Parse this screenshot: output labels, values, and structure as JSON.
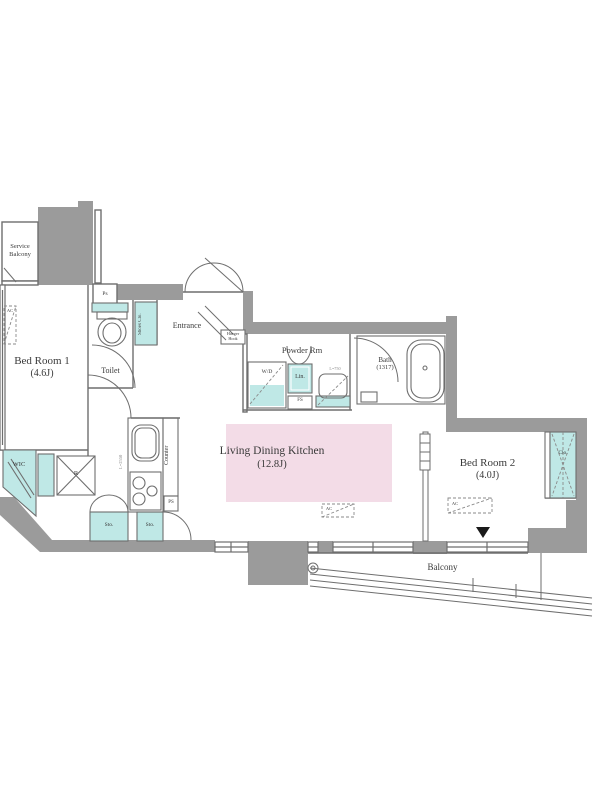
{
  "colors": {
    "wall": "#9b9b9b",
    "teal": "#bfe8e6",
    "pink": "#f3dce7",
    "line": "#6e6e6e",
    "text": "#3a3a3a"
  },
  "rooms": {
    "service_balcony": {
      "line1": "Service",
      "line2": "Balcony"
    },
    "bed_room_1": {
      "name": "Bed Room 1",
      "size": "(4.6J)"
    },
    "toilet": {
      "name": "Toilet"
    },
    "entrance": {
      "name": "Entrance"
    },
    "powder_room": {
      "name": "Powder Rm"
    },
    "bath": {
      "name": "Bath",
      "size": "(1317)"
    },
    "ldk": {
      "name": "Living Dining Kitchen",
      "size": "(12.8J)"
    },
    "bed_room_2": {
      "name": "Bed Room 2",
      "size": "(4.0J)"
    },
    "wic": {
      "name": "WIC"
    },
    "balcony": {
      "name": "Balcony"
    }
  },
  "fixtures": {
    "shoes_closet": "Shoes Clo.",
    "washer_dryer": "W/D",
    "linen": "Lin.",
    "fs": "FS",
    "ps_upper": "Ps",
    "ps_kitchen": "PS",
    "refrigerator": "R",
    "counter": "Counter",
    "storage_left": "Sto.",
    "storage_right": "Sto.",
    "closet_bedroom2": "Clo.",
    "hanger_hook": {
      "line1": "Hanger",
      "line2": "Hook"
    },
    "ac": "AC"
  },
  "dimensions": {
    "kitchen_counter": "L=2550",
    "washbasin": "L=750"
  }
}
